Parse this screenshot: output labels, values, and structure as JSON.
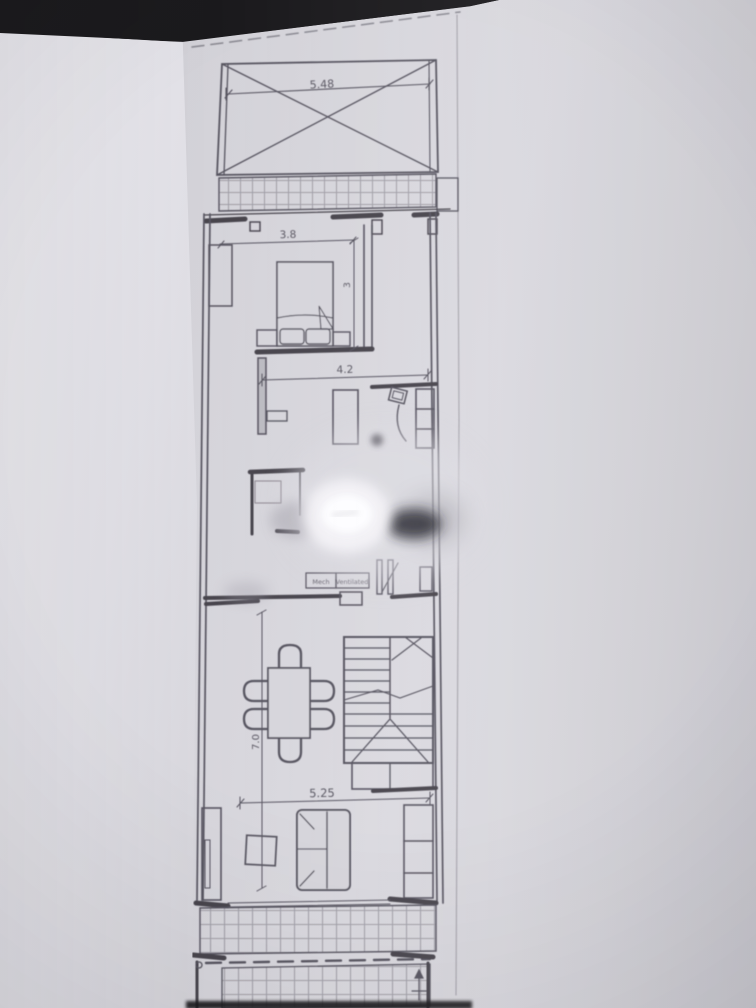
{
  "colors": {
    "background": "#1b1a1d",
    "paper": "#d7d6dc",
    "paper_light": "#eceaf0",
    "ink": "#4a4753",
    "wall_ink": "#37343e"
  },
  "floor_plan": {
    "dimensions": {
      "front_void_width": "5.48",
      "bedroom_width": "3.8",
      "bedroom_depth": "3",
      "kitchen_width": "4.2",
      "interior_length": "7.0",
      "living_width": "5.25"
    },
    "notes": {
      "vent_word_1": "Mech",
      "vent_word_2": "Ventilated"
    }
  }
}
